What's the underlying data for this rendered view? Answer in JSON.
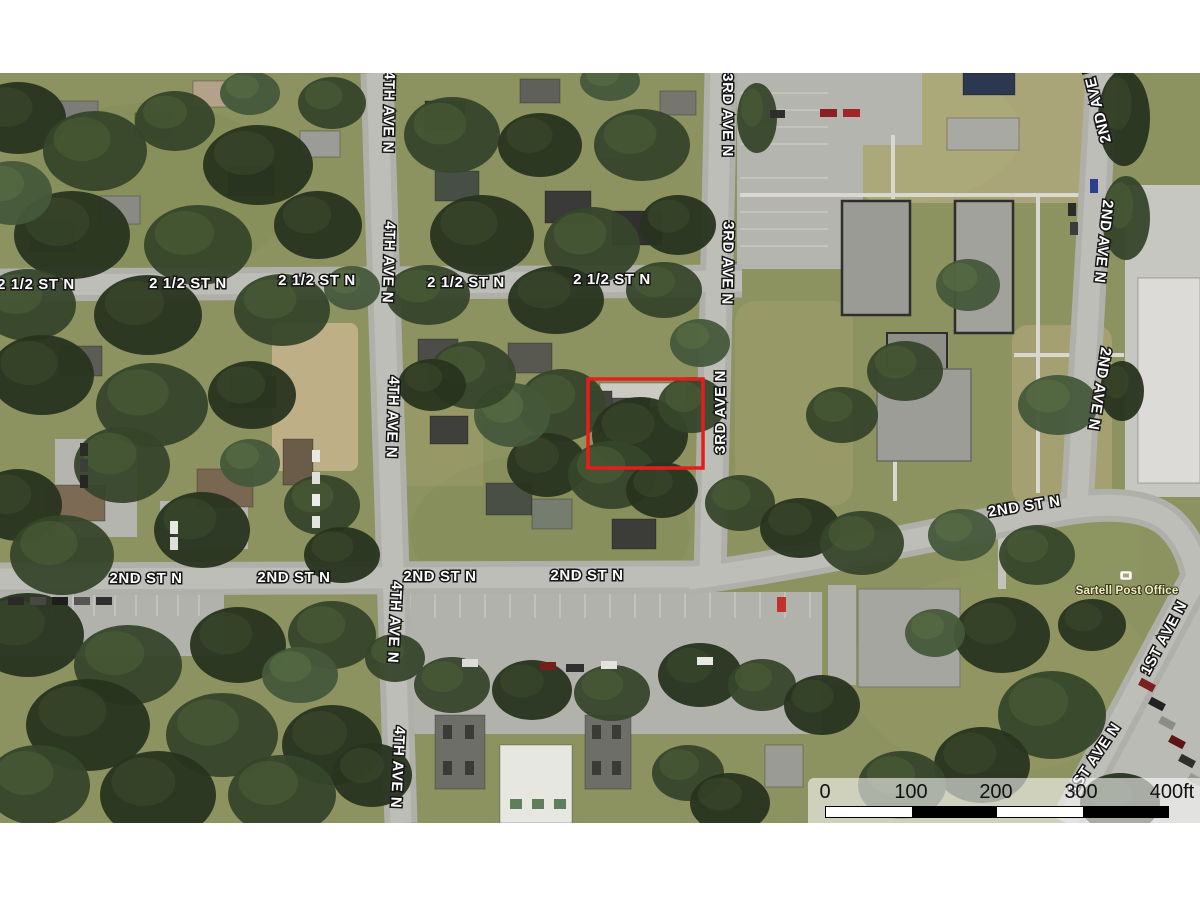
{
  "window": {
    "width": 1200,
    "height": 900,
    "background": "#ffffff"
  },
  "map": {
    "type": "satellite-aerial-view",
    "parcel": {
      "outline_color": "#e81c1c"
    },
    "poi": {
      "label": "Sartell Post Office",
      "label_color": "#f5efc0",
      "icon": "building-icon"
    },
    "street_labels": [
      {
        "text": "2 1/2 ST N"
      },
      {
        "text": "2 1/2 ST N"
      },
      {
        "text": "2 1/2 ST N"
      },
      {
        "text": "2 1/2 ST N"
      },
      {
        "text": "2 1/2 ST N"
      },
      {
        "text": "2ND ST N"
      },
      {
        "text": "2ND ST N"
      },
      {
        "text": "2ND ST N"
      },
      {
        "text": "2ND ST N"
      },
      {
        "text": "2ND ST N"
      },
      {
        "text": "4TH AVE N"
      },
      {
        "text": "4TH AVE N"
      },
      {
        "text": "4TH AVE N"
      },
      {
        "text": "4TH AVE N"
      },
      {
        "text": "4TH AVE N"
      },
      {
        "text": "3RD AVE N"
      },
      {
        "text": "3RD AVE N"
      },
      {
        "text": "3RD AVE N"
      },
      {
        "text": "2ND AVE N"
      },
      {
        "text": "2ND AVE N"
      },
      {
        "text": "2ND AVE N"
      },
      {
        "text": "1ST AVE N"
      },
      {
        "text": "1ST AVE N"
      }
    ],
    "scale_bar": {
      "ticks": [
        "0",
        "100",
        "200",
        "300",
        "400ft"
      ]
    }
  }
}
